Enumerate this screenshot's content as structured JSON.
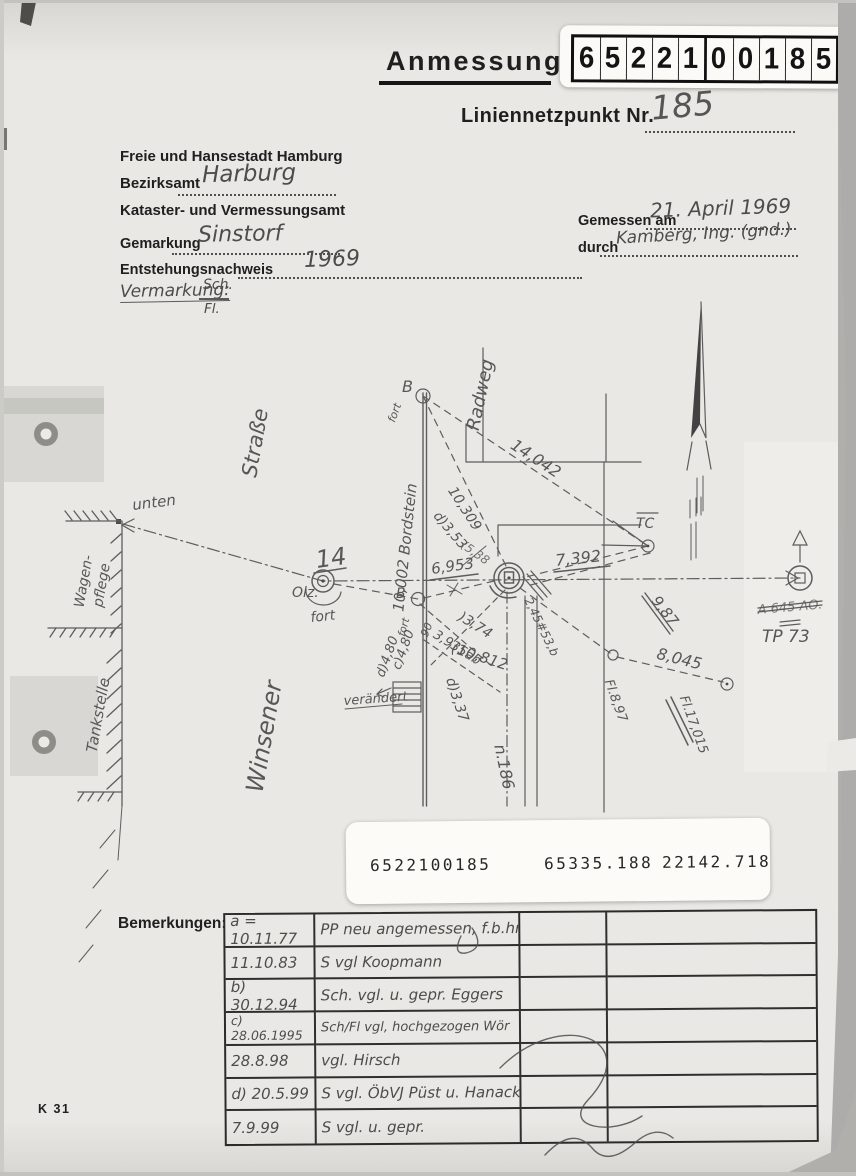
{
  "page": {
    "title": "Anmessung",
    "net_label": "Liniennetzpunkt Nr.",
    "net_number": "185",
    "digits": [
      "6",
      "5",
      "2",
      "2",
      "1",
      "0",
      "0",
      "1",
      "8",
      "5"
    ]
  },
  "agency": {
    "line1": "Freie und Hansestadt Hamburg",
    "bezirksamt_label": "Bezirksamt",
    "bezirksamt_value": "Harburg",
    "line3": "Kataster- und Vermessungsamt"
  },
  "form": {
    "gemarkung_label": "Gemarkung",
    "gemarkung_value": "Sinstorf",
    "entstehung_label": "Entstehungsnachweis",
    "entstehung_value": "1969",
    "vermarkung_label": "Vermarkung:",
    "vermarkung_top": "Sch.",
    "vermarkung_bottom": "Fl.",
    "gemessen_label": "Gemessen am",
    "gemessen_value": "21. April 1969",
    "durch_label": "durch",
    "durch_value": "Kamberg, Ing. (gnd.)"
  },
  "id_strip": {
    "point_id": "6522100185",
    "coord_x": "65335.188",
    "coord_y": "22142.718"
  },
  "sketch": {
    "strasse": "Straße",
    "winsener": "Winsener",
    "radweg": "Radweg",
    "bordstein": "10,002 Bordstein",
    "b_top": "B",
    "fort_top": "fort",
    "m_14042": "14,042",
    "m_10309": "10,309",
    "m_d353": "d)3,53",
    "m_538": "(5,38",
    "m_6953": "6,953",
    "m_7392": "7,392",
    "tc": "TC",
    "m_987": "9,87",
    "tp73_crossed": "A 645 AO.",
    "tp73": "TP 73",
    "unten": "unten",
    "wagen1": "Wagen-",
    "wagen2": "pflege",
    "tankstelle": "Tankstelle",
    "pt14": "14",
    "olz": "Olz.",
    "fort_left": "fort",
    "b_mid": "B",
    "fort_mid": "fort",
    "m_90": "90",
    "m_d480": "d)4,80",
    "m_c480": "c)4,80",
    "m_3935": "3,935ab",
    "m_374": ")3,74",
    "m_10812": "(10,812",
    "m_d337": "d)3,37",
    "veraendert": "verändert",
    "m_245": "2,45#53,b",
    "m_8045": "8,045",
    "fl_897": "Fl.8,97",
    "fl_17015": "Fl.17,015",
    "n_186": "n.186"
  },
  "remarks": {
    "label": "Bemerkungen:",
    "rows": [
      {
        "date": "a = 10.11.77",
        "text": "PP neu angemessen, f.b.hr."
      },
      {
        "date": "11.10.83",
        "text": "S vgl Koopmann"
      },
      {
        "date": "b) 30.12.94",
        "text": "Sch. vgl. u. gepr. Eggers"
      },
      {
        "date": "c) 28.06.1995",
        "text": "Sch/Fl vgl, hochgezogen Wör"
      },
      {
        "date": "28.8.98",
        "text": "vgl. Hirsch"
      },
      {
        "date": "d) 20.5.99",
        "text": "S vgl. ÖbVJ Püst u. Hanack"
      },
      {
        "date": "7.9.99",
        "text": "S vgl. u. gepr."
      }
    ]
  },
  "footer": {
    "code": "K 31"
  }
}
